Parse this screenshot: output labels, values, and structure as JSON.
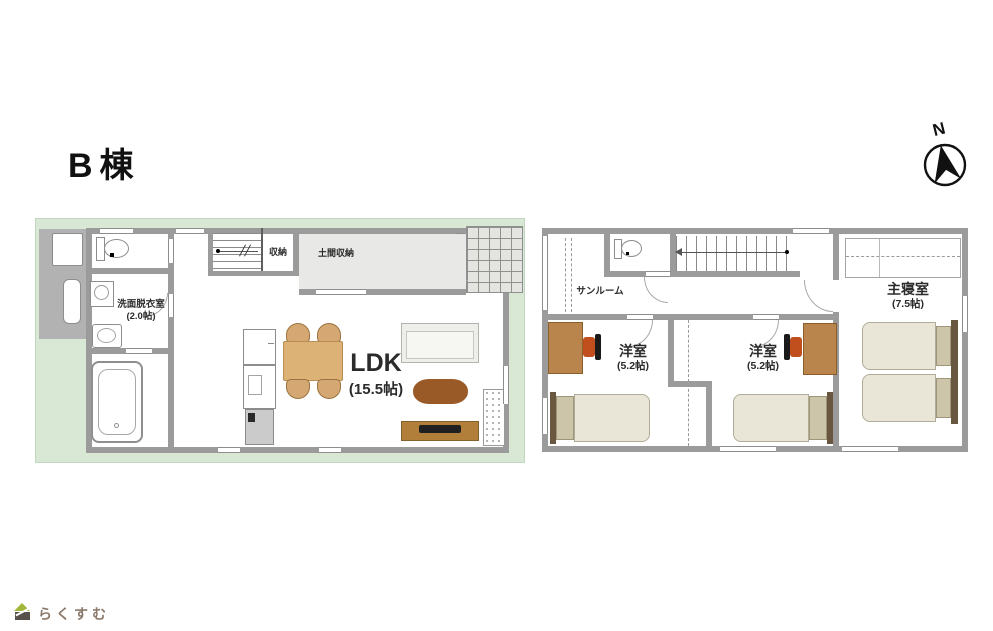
{
  "title": "B棟",
  "compass": {
    "north_label": "N"
  },
  "floor1": {
    "rooms": {
      "washroom": {
        "name": "洗面脱衣室",
        "size": "(2.0帖)"
      },
      "closet": {
        "name": "収納"
      },
      "doma": {
        "name": "土間収納"
      },
      "ldk": {
        "name": "LDK",
        "size": "(15.5帖)"
      }
    }
  },
  "floor2": {
    "rooms": {
      "sunroom": {
        "name": "サンルーム"
      },
      "west1": {
        "name": "洋室",
        "size": "(5.2帖)"
      },
      "west2": {
        "name": "洋室",
        "size": "(5.2帖)"
      },
      "master": {
        "name": "主寝室",
        "size": "(7.5帖)"
      }
    }
  },
  "logo": {
    "text": "らくすむ"
  },
  "colors": {
    "site_green": "#d9e8d4",
    "wall_gray": "#9b9b9b",
    "doma_floor": "#e8e8e6",
    "table_tan": "#dcb277",
    "coffee_table_brown": "#9a5a28",
    "tv_board_brown": "#b17f3a",
    "desk_brown": "#b9854c",
    "chair_orange": "#c14f1e",
    "bed_beige": "#e9e6d8",
    "logo_text": "#8b7a6c"
  }
}
